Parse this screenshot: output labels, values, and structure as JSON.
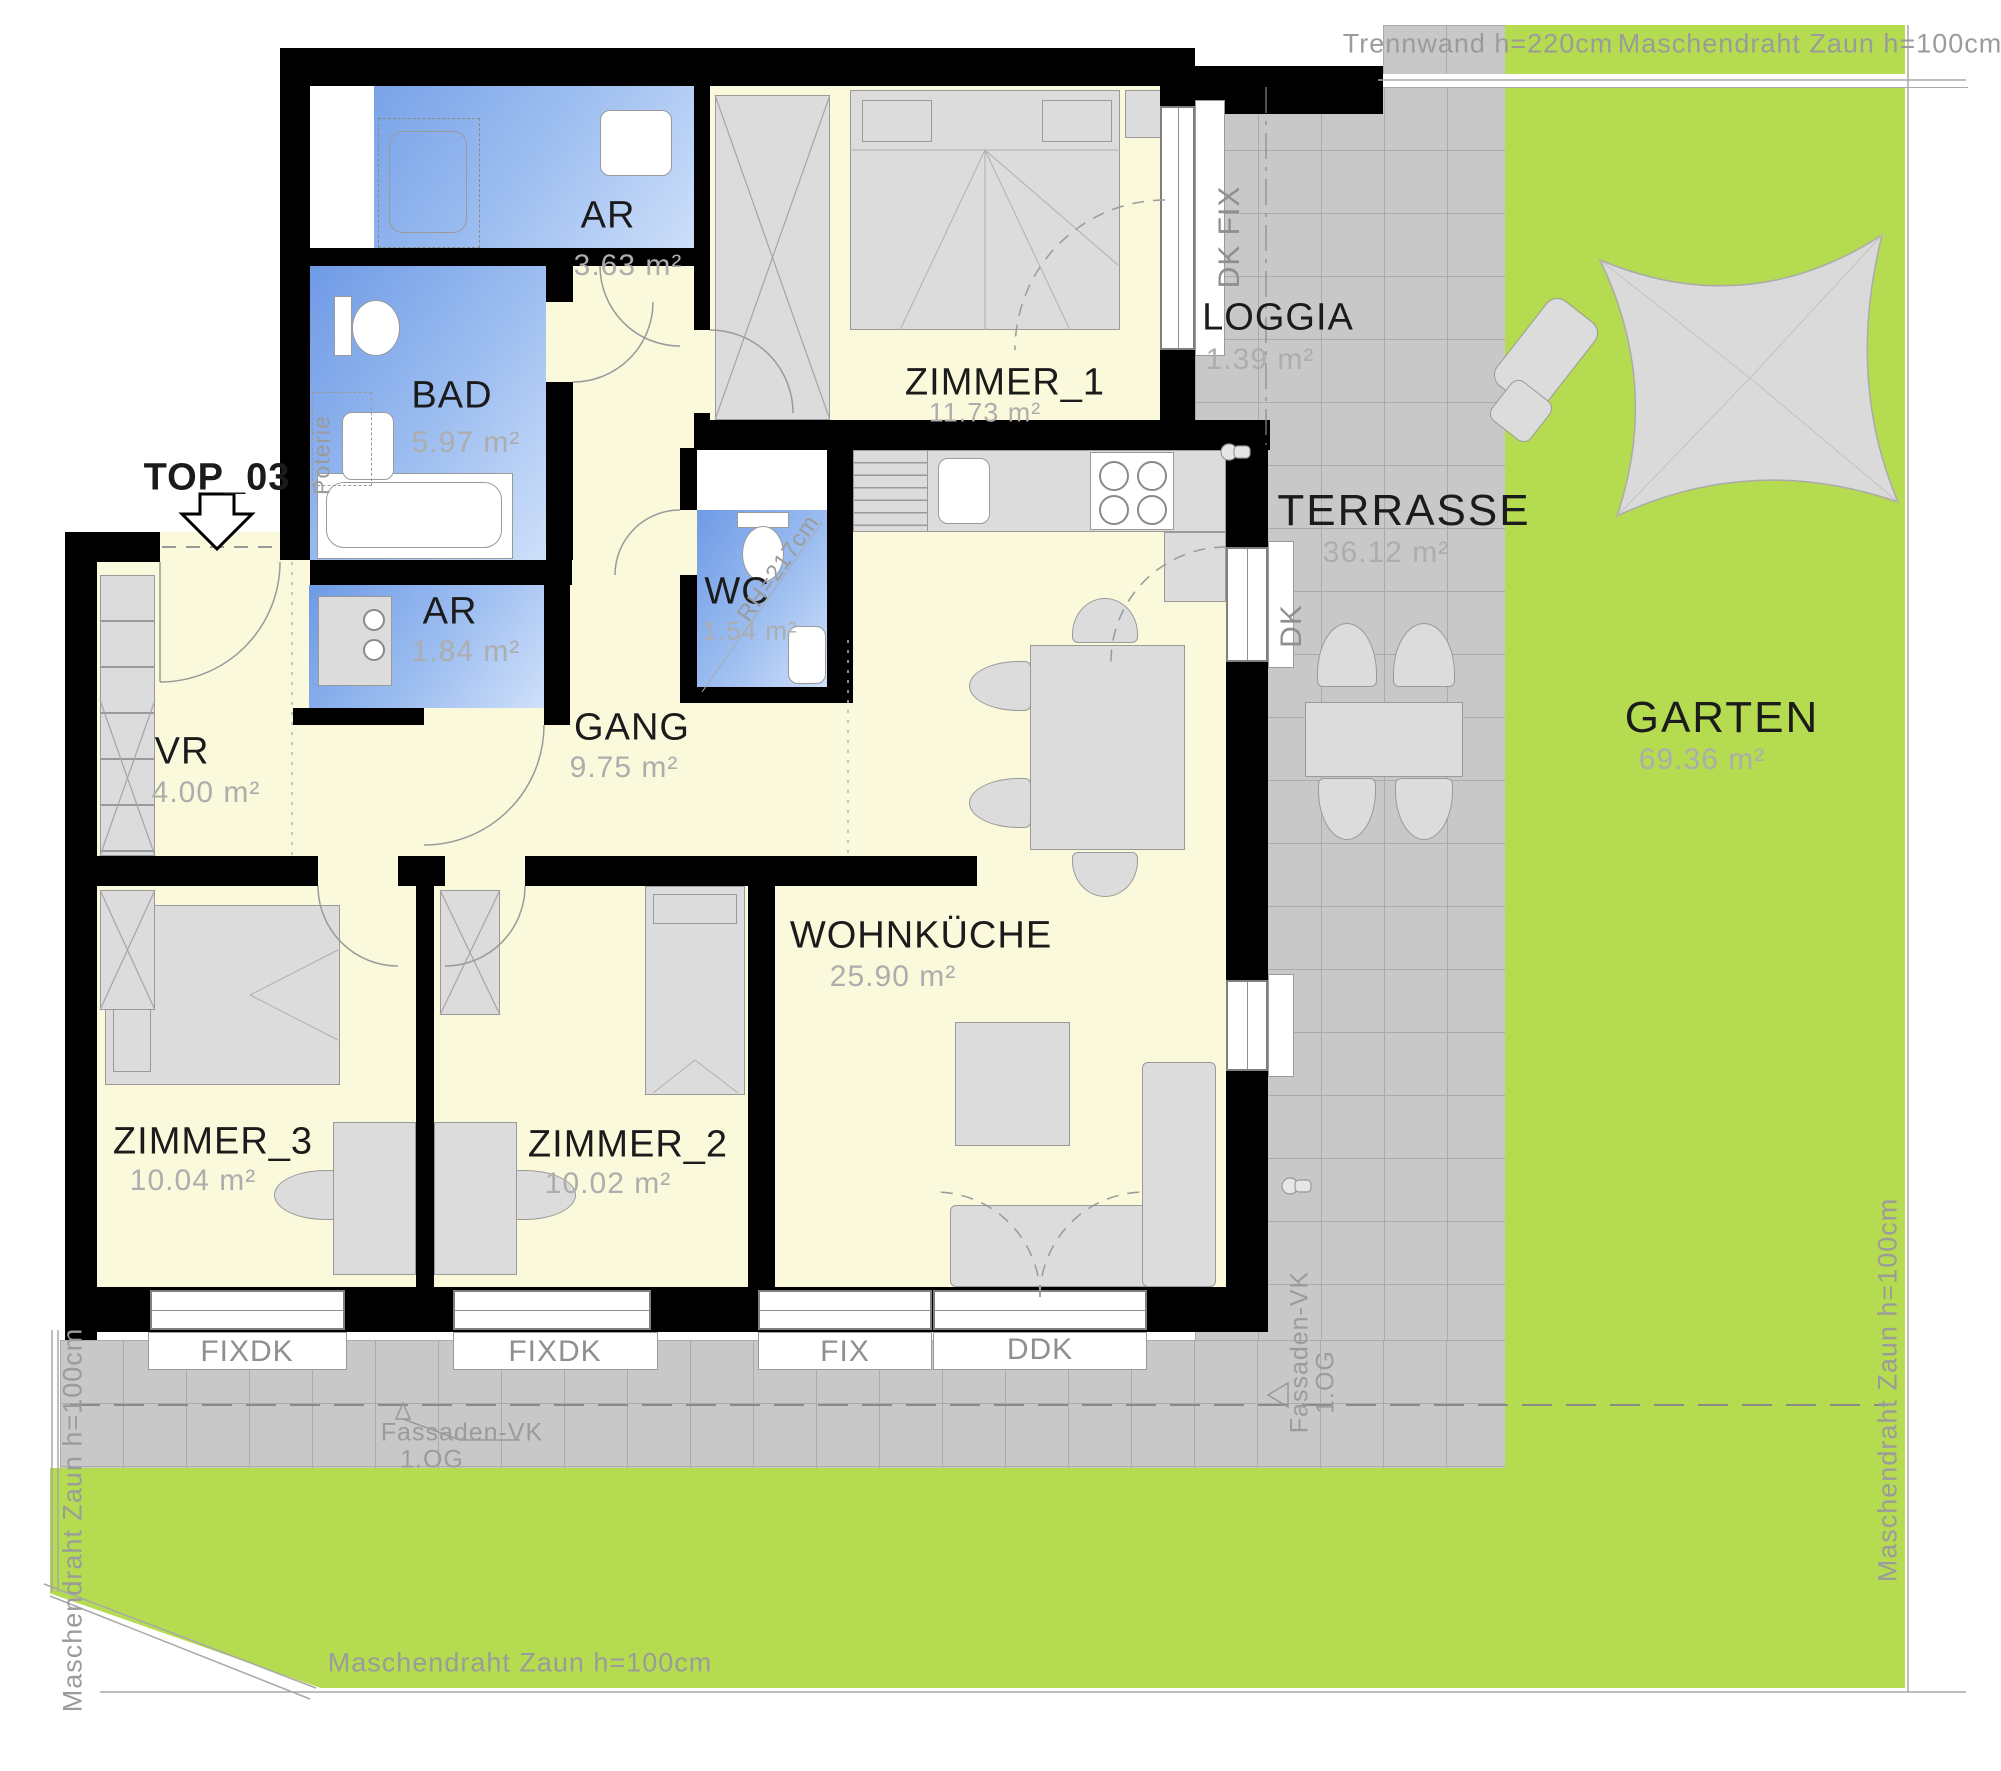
{
  "title": "TOP_03",
  "rooms": [
    {
      "name": "AR",
      "area": "3.63 m²"
    },
    {
      "name": "BAD",
      "area": "5.97 m²"
    },
    {
      "name": "ZIMMER_1",
      "area": "11.73 m²"
    },
    {
      "name": "LOGGIA",
      "area": "1.39 m²"
    },
    {
      "name": "AR",
      "area": "1.84 m²"
    },
    {
      "name": "WC",
      "area": "1.54 m²"
    },
    {
      "name": "VR",
      "area": "4.00 m²"
    },
    {
      "name": "GANG",
      "area": "9.75 m²"
    },
    {
      "name": "WOHNKÜCHE",
      "area": "25.90 m²"
    },
    {
      "name": "ZIMMER_3",
      "area": "10.04 m²"
    },
    {
      "name": "ZIMMER_2",
      "area": "10.02 m²"
    },
    {
      "name": "TERRASSE",
      "area": "36.12 m²"
    },
    {
      "name": "GARTEN",
      "area": "69.36 m²"
    }
  ],
  "annotations": {
    "top_label": "TOP_03",
    "trennwand": "Trennwand h=220cm",
    "fence": "Maschendraht Zaun h=100cm",
    "room_height": "RH=217cm",
    "poterie": "Poterie",
    "fassade": "Fassaden-VK",
    "floor": "1.OG",
    "dk_fix": "DK  FIX",
    "dk": "DK"
  },
  "windows": {
    "labels": [
      "FIXDK",
      "FIXDK",
      "FIX",
      "DDK"
    ]
  },
  "colors": {
    "wall": "#000000",
    "room": "#FAF9DB",
    "wet": "#7FA5E8",
    "terrace": "#C8C8C8",
    "garden": "#B5DB50"
  }
}
